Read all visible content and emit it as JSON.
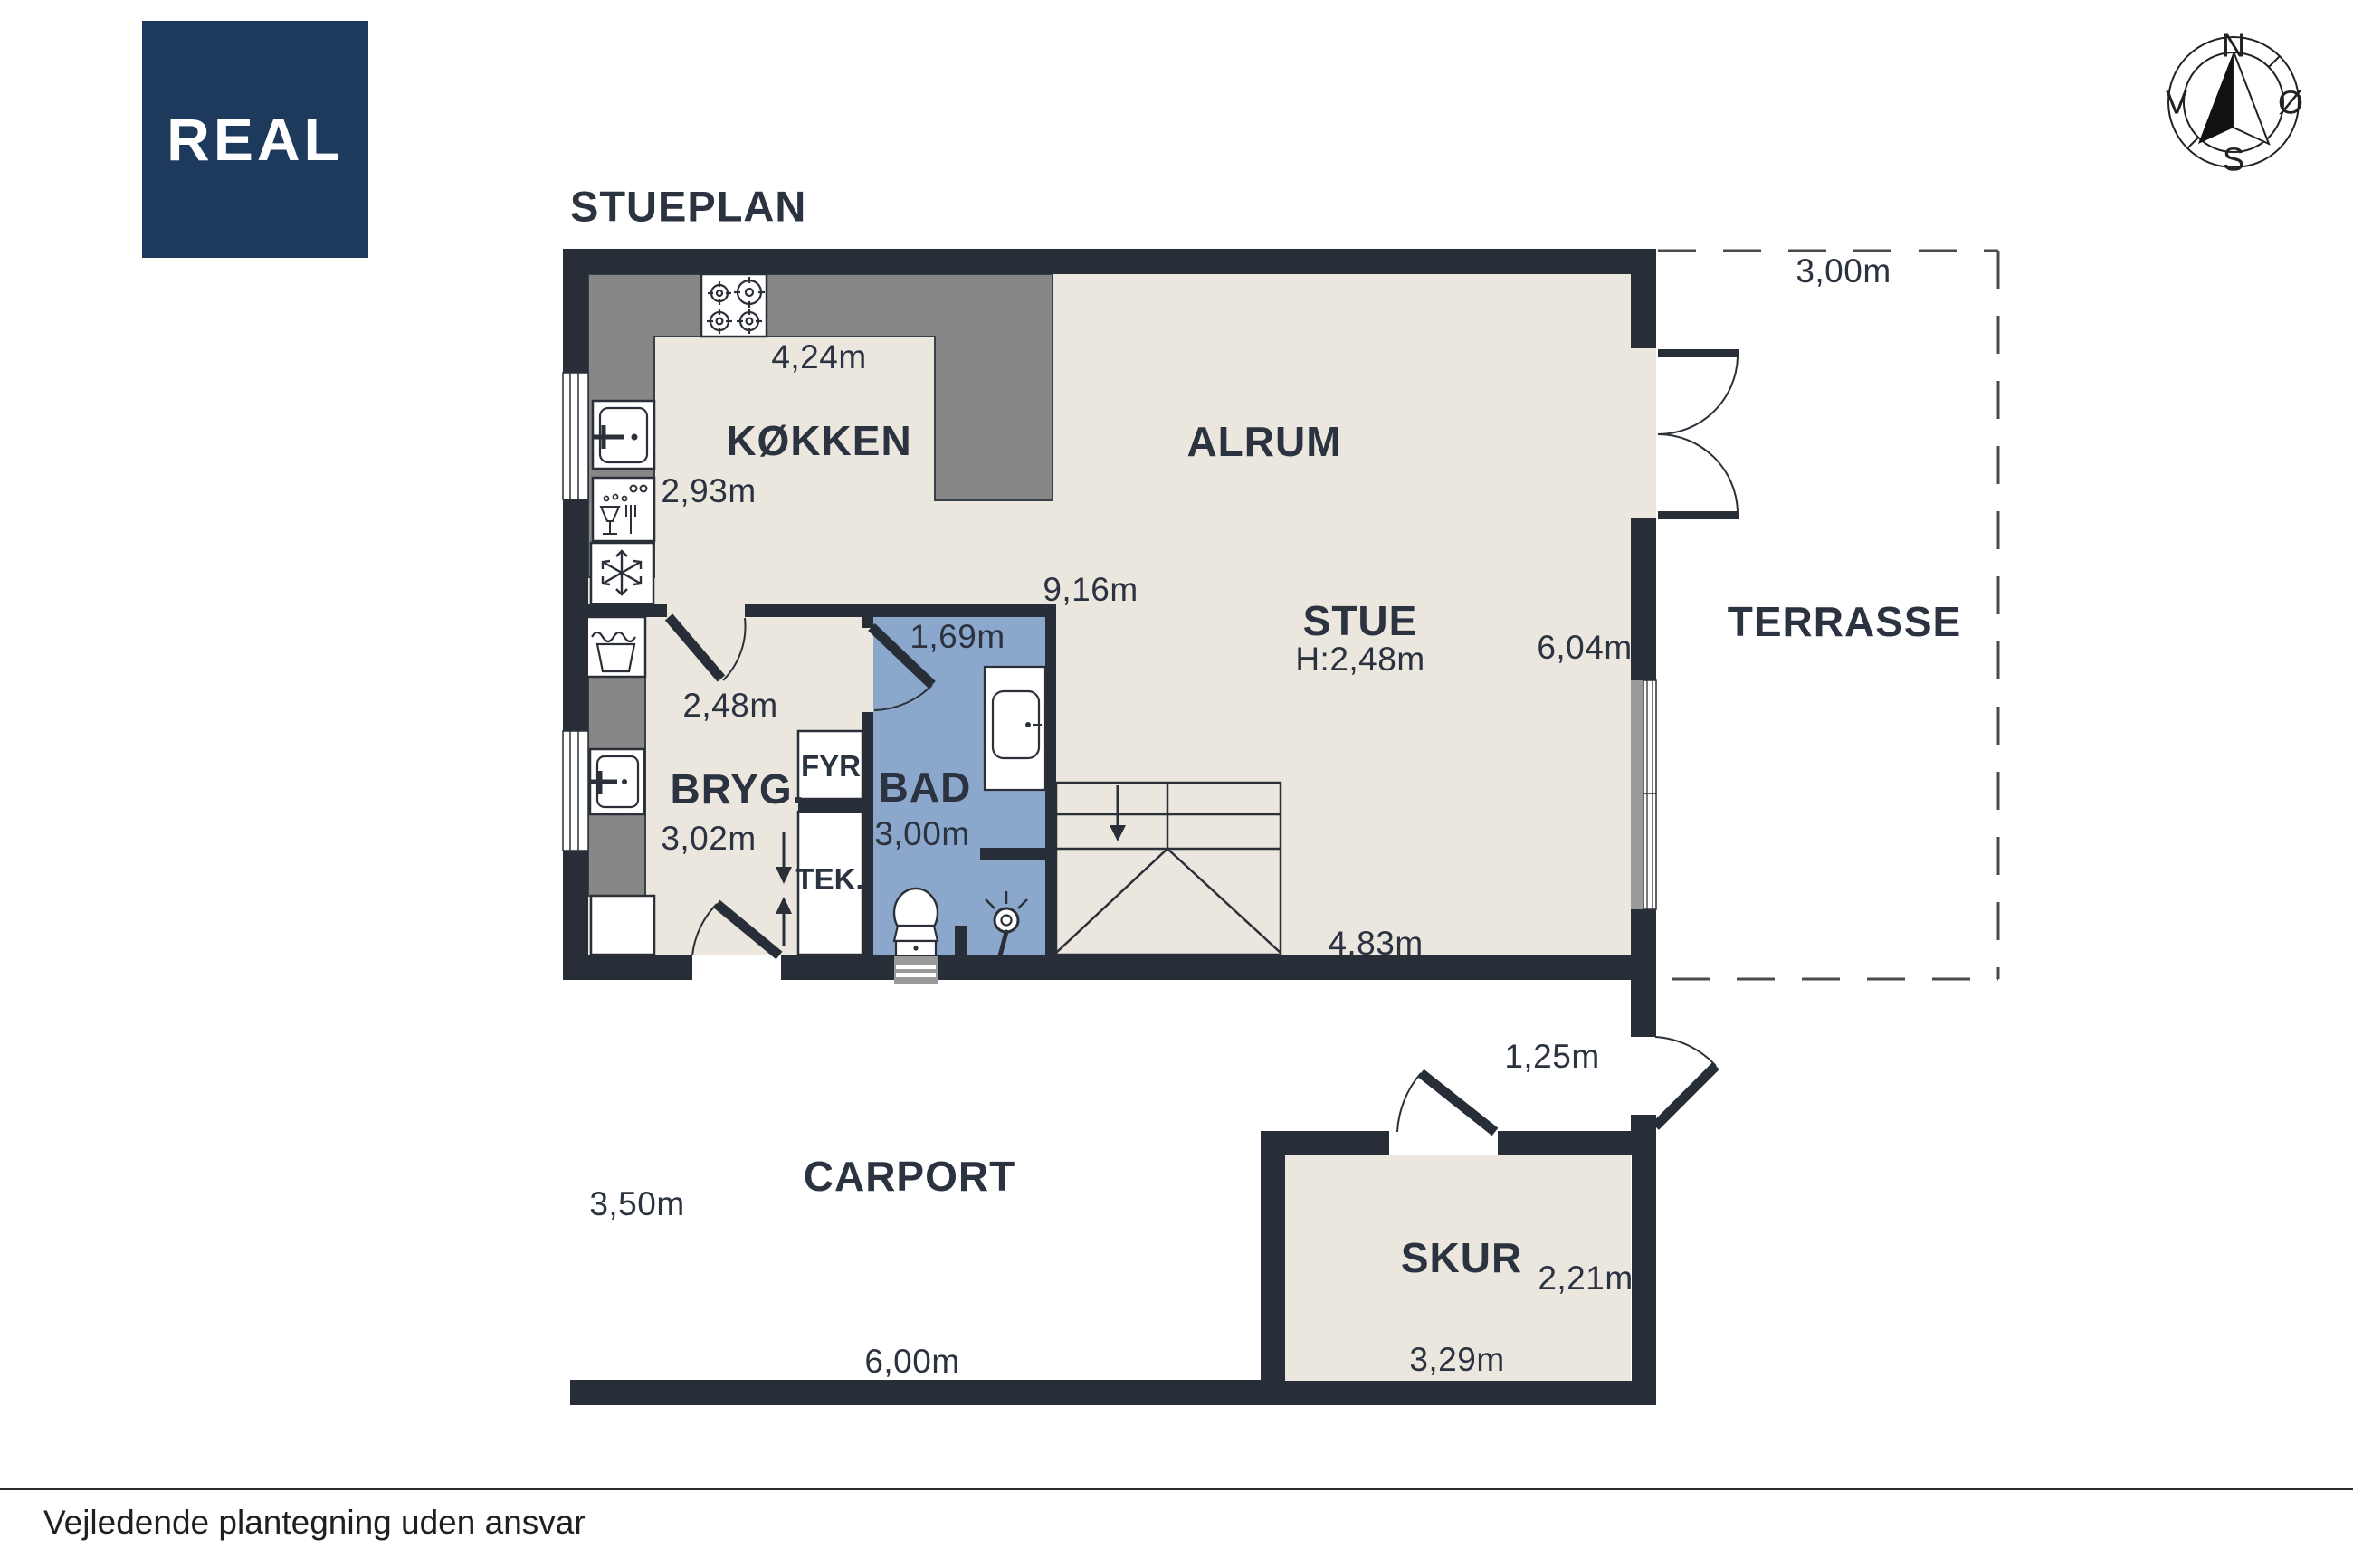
{
  "page": {
    "title": "STUEPLAN",
    "disclaimer": "Vejledende plantegning uden ansvar"
  },
  "logo": {
    "text": "REAL",
    "background": "#1d3a5c"
  },
  "compass": {
    "north": "N",
    "east": "Ø",
    "south": "S",
    "west": "V"
  },
  "rooms": {
    "kokken": {
      "name": "KØKKEN",
      "width": "4,24m",
      "depth": "2,93m"
    },
    "alrum": {
      "name": "ALRUM"
    },
    "stue": {
      "name": "STUE",
      "ceiling_height": "H:2,48m",
      "width": "9,16m",
      "depth": "6,04m",
      "bottom_width": "4,83m"
    },
    "bryg": {
      "name": "BRYG.",
      "door_width": "2,48m",
      "depth": "3,02m"
    },
    "fyr": {
      "name": "FYR"
    },
    "tek": {
      "name": "TEK."
    },
    "bad": {
      "name": "BAD",
      "width": "1,69m",
      "depth": "3,00m"
    },
    "terrasse": {
      "name": "TERRASSE",
      "width": "3,00m"
    },
    "passage": {
      "door_width": "1,25m"
    },
    "carport": {
      "name": "CARPORT",
      "depth": "3,50m",
      "width": "6,00m"
    },
    "skur": {
      "name": "SKUR",
      "width": "3,29m",
      "depth": "2,21m"
    }
  },
  "colors": {
    "wall": "#282e37",
    "floor": "#ebe6de",
    "bathroom_floor": "#8ba7cb",
    "counter": "#878787",
    "line": "#2b3038",
    "text": "#2b3240",
    "logo_navy": "#1d3a5c"
  }
}
